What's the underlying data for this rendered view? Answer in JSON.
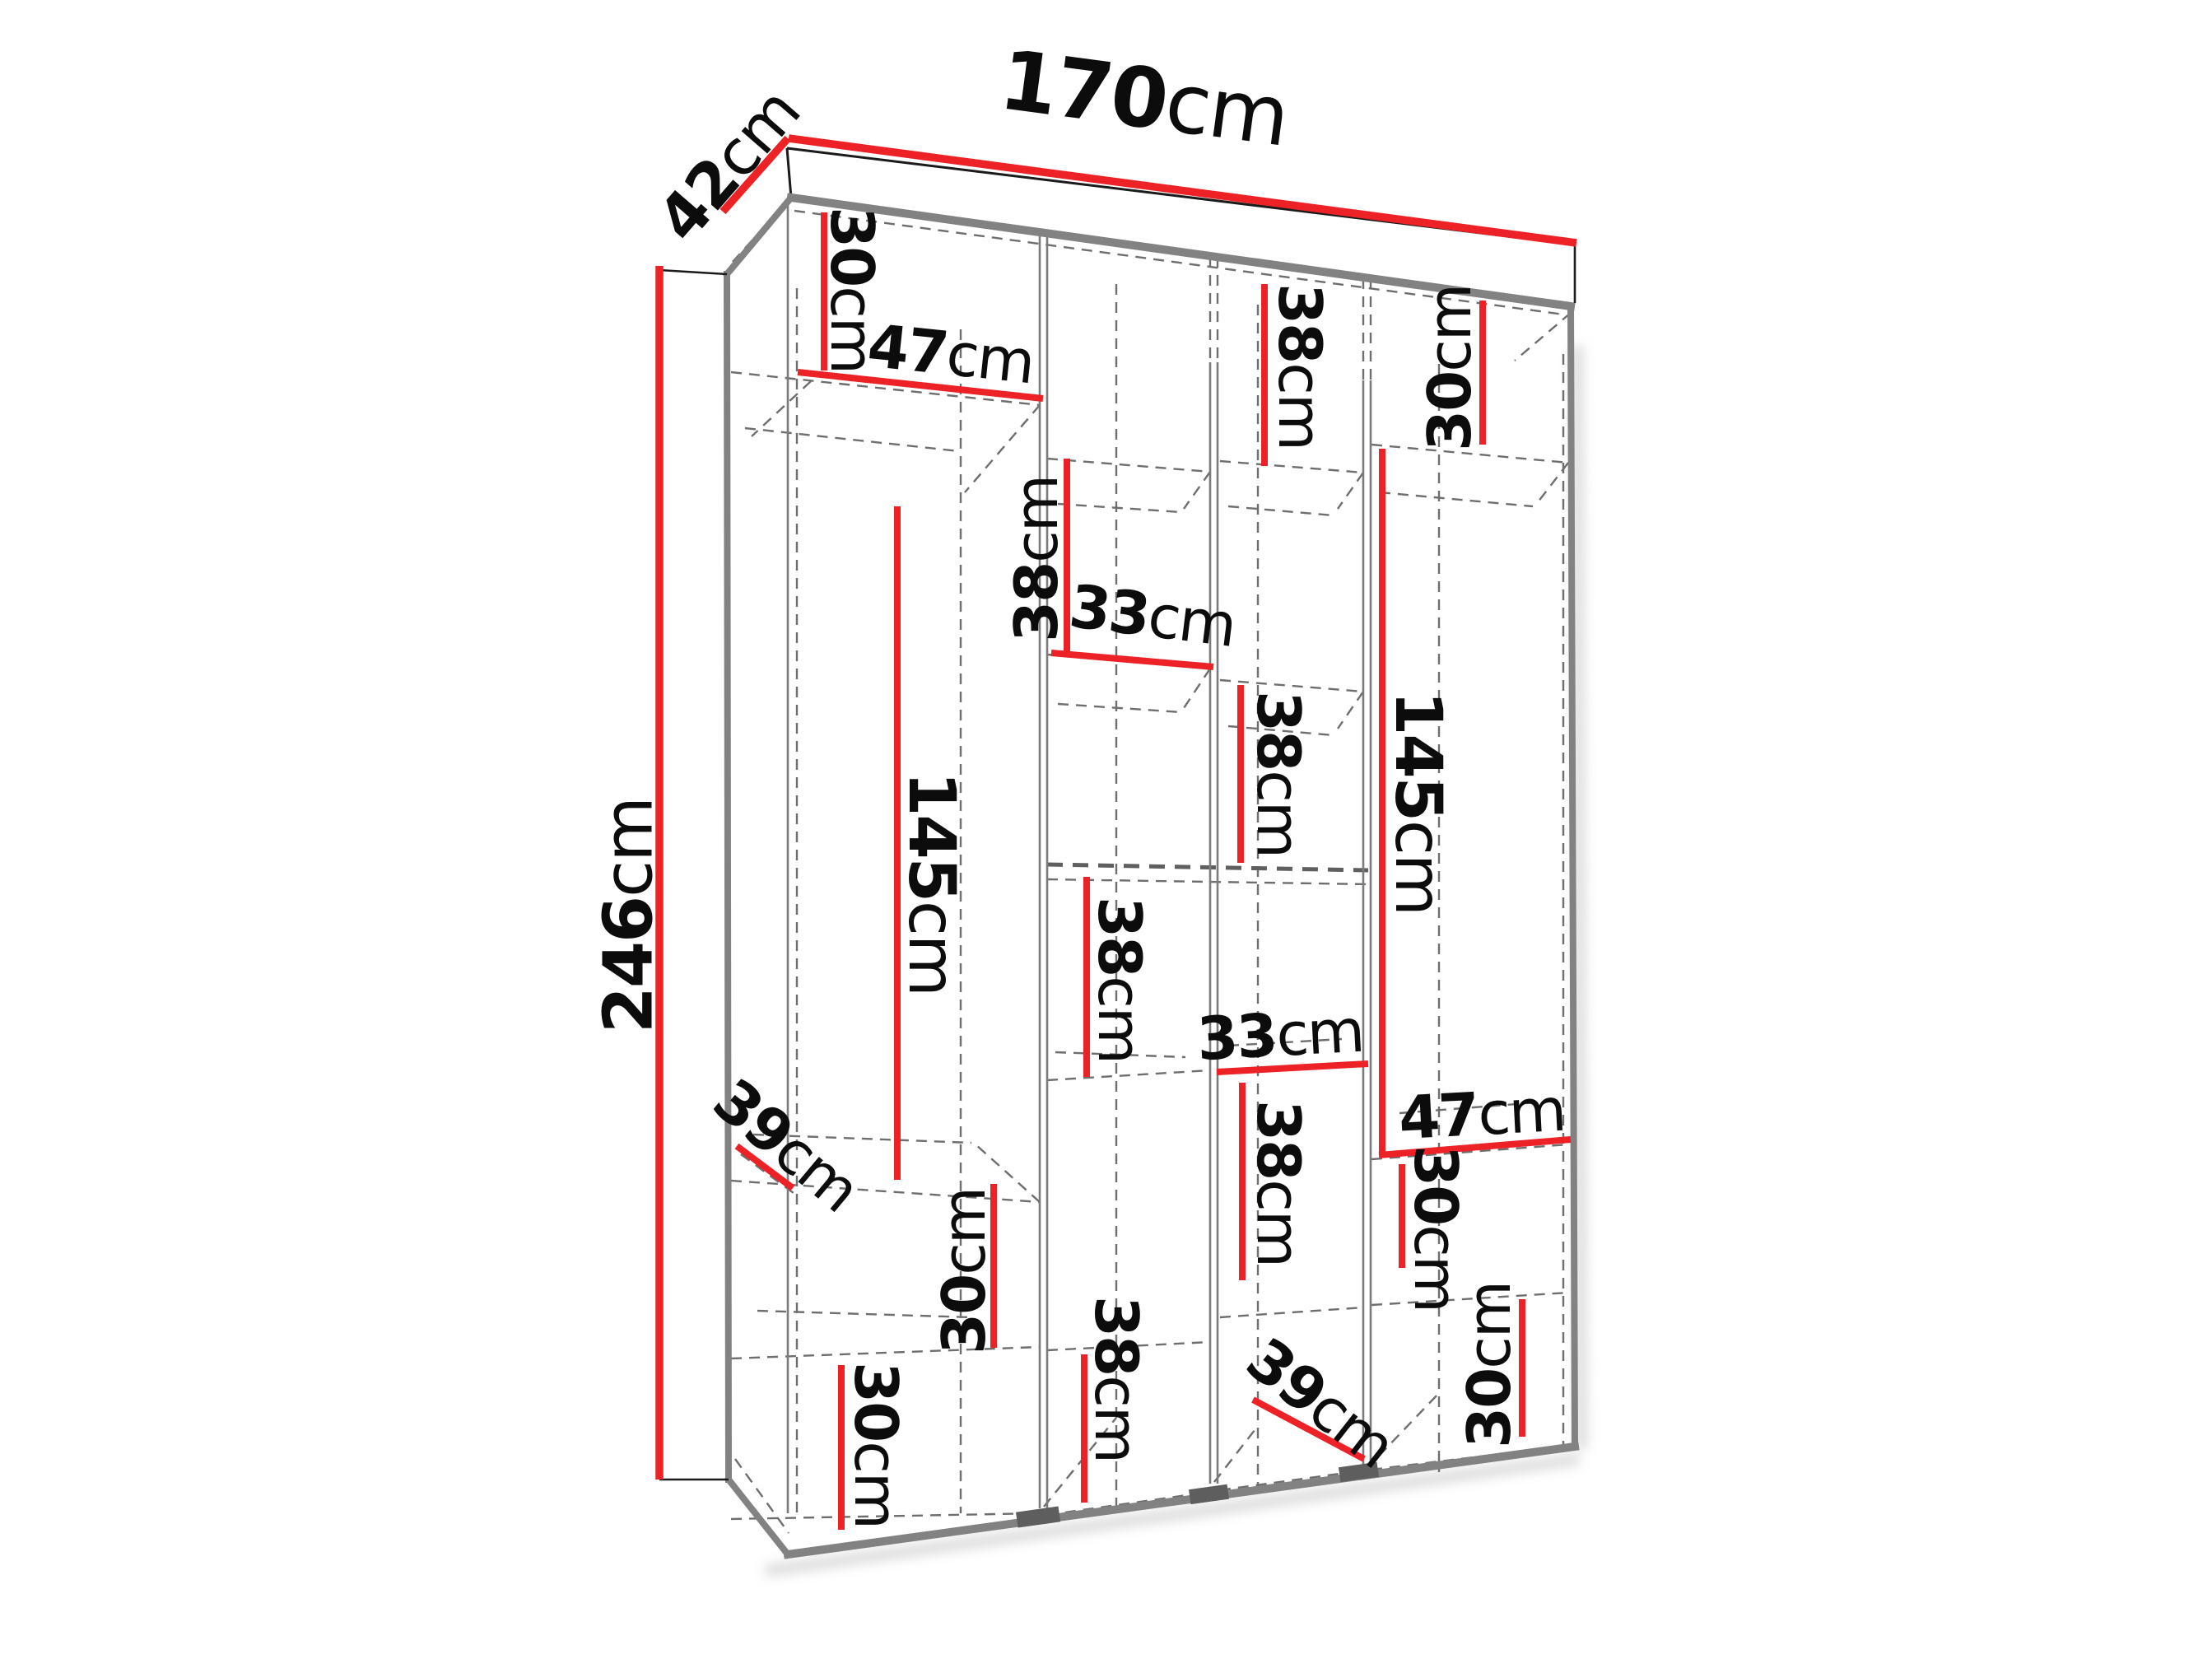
{
  "diagram": {
    "type": "wardrobe-dimension-drawing",
    "unit": "cm",
    "colors": {
      "dimension_line": "#EC2227",
      "visible_edge": "#828282",
      "hidden_edge": "#6e6e6e",
      "outline": "#1b1b1b",
      "label_text": "#0c0c0c",
      "background": "#ffffff"
    }
  },
  "dimensions": {
    "overall_width": {
      "value": "170",
      "unit": "cm"
    },
    "overall_depth": {
      "value": "42",
      "unit": "cm"
    },
    "overall_height": {
      "value": "246",
      "unit": "cm"
    },
    "c1_top_height": {
      "value": "30",
      "unit": "cm"
    },
    "c1_width": {
      "value": "47",
      "unit": "cm"
    },
    "c1_hanging_height": {
      "value": "145",
      "unit": "cm"
    },
    "c1_shelf_depth": {
      "value": "39",
      "unit": "cm"
    },
    "c1_lower_height": {
      "value": "30",
      "unit": "cm"
    },
    "c1_bottom_height": {
      "value": "30",
      "unit": "cm"
    },
    "c2_upper_height": {
      "value": "38",
      "unit": "cm"
    },
    "c2_width": {
      "value": "33",
      "unit": "cm"
    },
    "c2_middle_height": {
      "value": "38",
      "unit": "cm"
    },
    "c2_bottom_height": {
      "value": "38",
      "unit": "cm"
    },
    "c3_top_height": {
      "value": "38",
      "unit": "cm"
    },
    "c3_upper_height": {
      "value": "38",
      "unit": "cm"
    },
    "c3_width": {
      "value": "33",
      "unit": "cm"
    },
    "c3_lower_height": {
      "value": "38",
      "unit": "cm"
    },
    "c3_shelf_depth": {
      "value": "39",
      "unit": "cm"
    },
    "c4_top_height": {
      "value": "30",
      "unit": "cm"
    },
    "c4_hanging_height": {
      "value": "145",
      "unit": "cm"
    },
    "c4_width": {
      "value": "47",
      "unit": "cm"
    },
    "c4_middle_height": {
      "value": "30",
      "unit": "cm"
    },
    "c4_bottom_height": {
      "value": "30",
      "unit": "cm"
    }
  }
}
